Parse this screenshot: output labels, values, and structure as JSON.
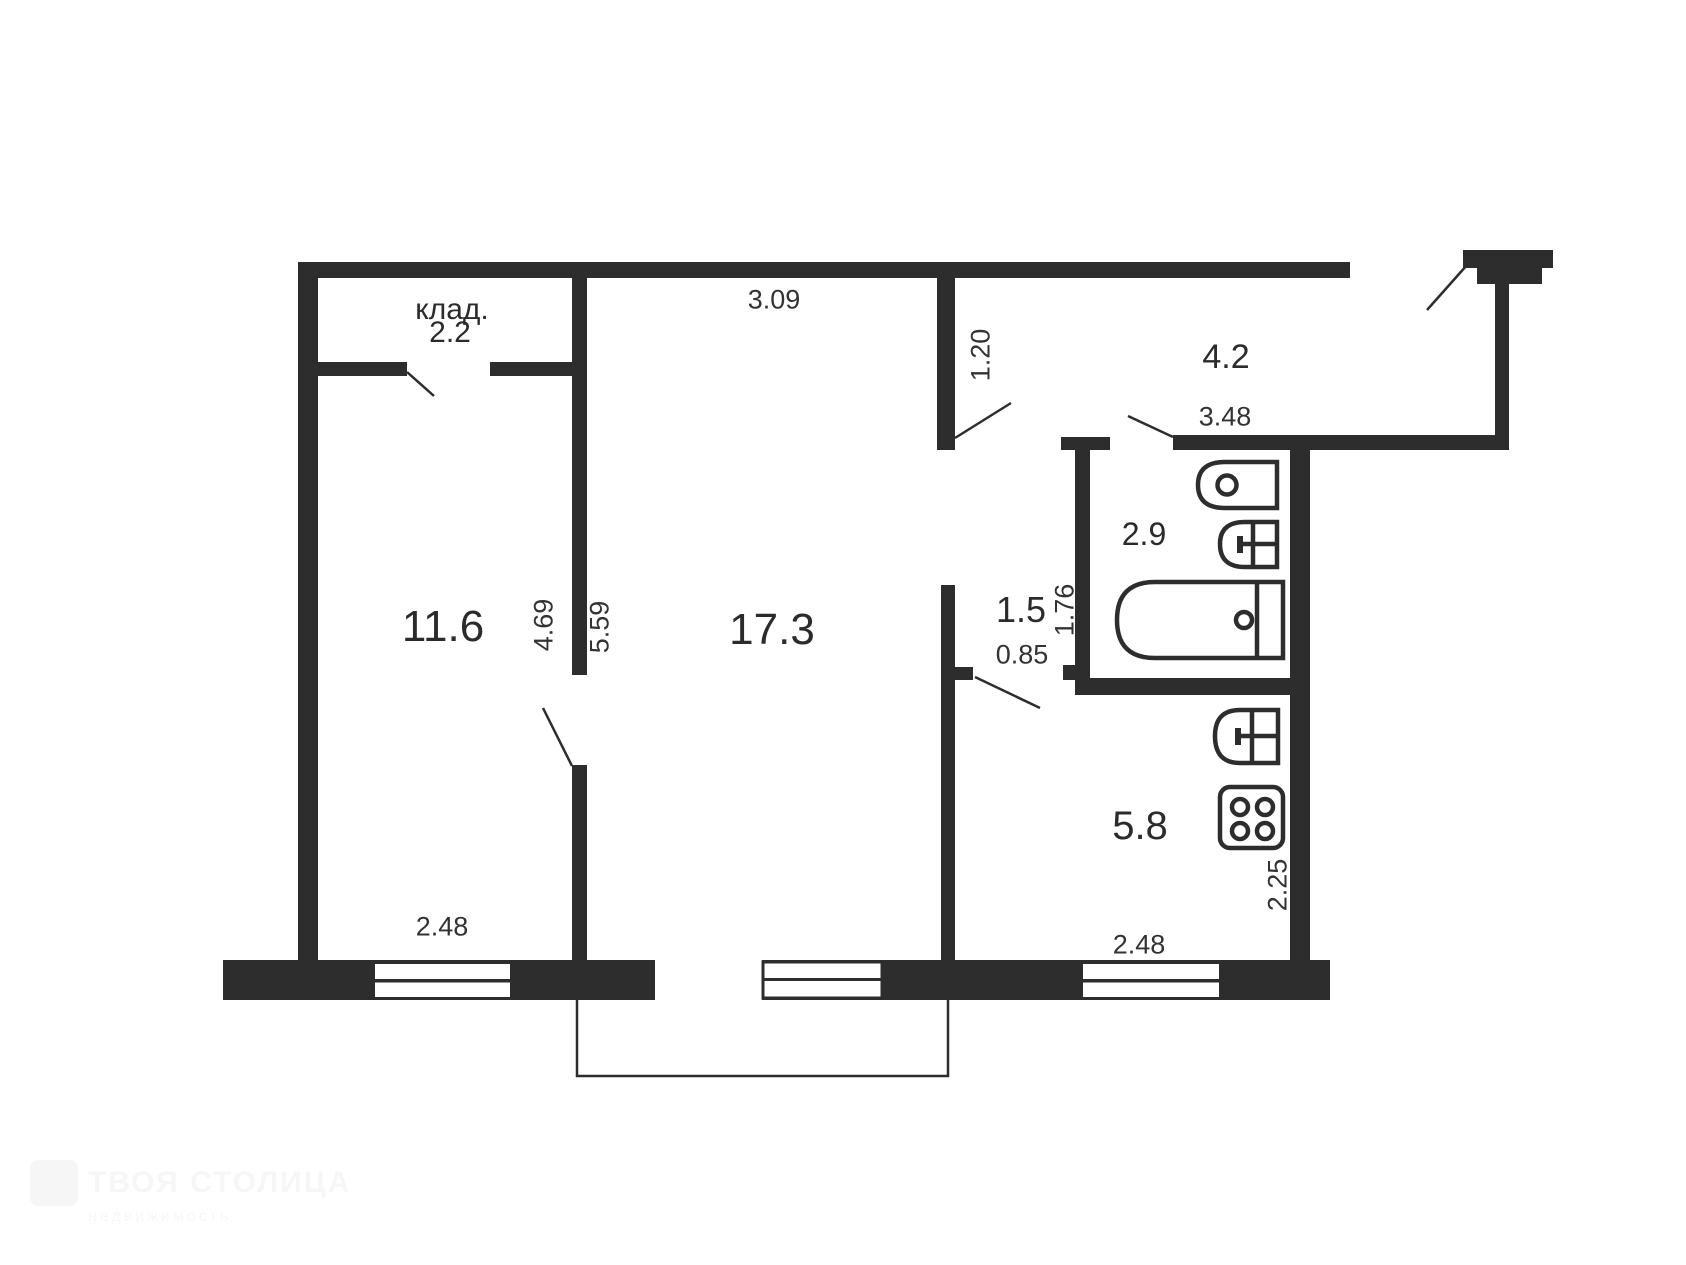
{
  "floorplan": {
    "rooms": {
      "closet": {
        "name": "клад.",
        "area": "2.2"
      },
      "bedroom": {
        "area": "11.6"
      },
      "living": {
        "area": "17.3"
      },
      "hall": {
        "area": "4.2"
      },
      "bathroom": {
        "area": "2.9"
      },
      "corridor": {
        "area": "1.5"
      },
      "kitchen": {
        "area": "5.8"
      }
    },
    "dimensions": {
      "living_top_width": "3.09",
      "hall_wall_depth": "1.20",
      "hall_bottom_width": "3.48",
      "bedroom_wall_height": "4.69",
      "living_wall_height": "5.59",
      "bathroom_wall_height": "1.76",
      "corridor_door_width": "0.85",
      "bedroom_window_width": "2.48",
      "kitchen_window_width": "2.48",
      "kitchen_wall_height": "2.25"
    }
  },
  "watermark": {
    "line1": "ТВОЯ СТОЛИЦА",
    "line2": "недвижимость"
  }
}
